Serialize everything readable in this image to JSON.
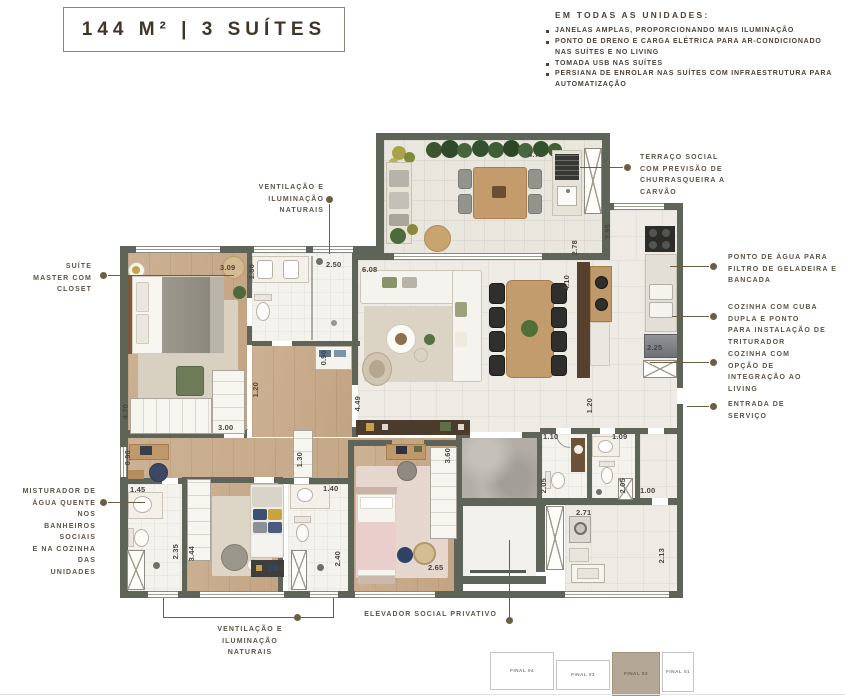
{
  "title": "144 M² | 3 SUÍTES",
  "features": {
    "heading": "EM TODAS AS UNIDADES:",
    "items": [
      "JANELAS AMPLAS, PROPORCIONANDO MAIS ILUMINAÇÃO",
      "PONTO DE DRENO E CARGA ELÉTRICA PARA AR-CONDICIONADO NAS SUÍTES E NO LIVING",
      "TOMADA USB NAS SUÍTES",
      "PERSIANA DE ENROLAR NAS SUÍTES COM INFRAESTRUTURA PARA AUTOMATIZAÇÃO"
    ]
  },
  "callouts": {
    "suite_master": "SUÍTE\nMASTER COM\nCLOSET",
    "ventilacao_top": "VENTILAÇÃO E\nILUMINAÇÃO\nNATURAIS",
    "terraco": "TERRAÇO SOCIAL\nCOM PREVISÃO DE\nCHURRASQUEIRA A\nCARVÃO",
    "ponto_agua": "PONTO DE ÁGUA PARA\nFILTRO DE GELADEIRA E\nBANCADA",
    "cozinha_cuba": "COZINHA COM CUBA\nDUPLA E PONTO\nPARA INSTALAÇÃO DE\nTRITURADOR",
    "cozinha_living": "COZINHA COM\nOPÇÃO DE\nINTEGRAÇÃO AO\nLIVING",
    "entrada_servico": "ENTRADA DE\nSERVIÇO",
    "misturador": "MISTURADOR DE\nÁGUA QUENTE NOS\nBANHEIROS SOCIAIS\nE NA COZINHA DAS\nUNIDADES",
    "ventilacao_bottom": "VENTILAÇÃO E\nILUMINAÇÃO\nNATURAIS",
    "elevador": "ELEVADOR SOCIAL PRIVATIVO"
  },
  "dims": [
    "4.70",
    "3.95",
    "2.78",
    "4.10",
    "2.25",
    "6.08",
    "4.49",
    "1.20",
    "1.10",
    "1.09",
    "2.05",
    "2.05",
    "1.00",
    "2.71",
    "2.13",
    "3.09",
    "1.80",
    "2.50",
    "0.90",
    "1.20",
    "4.70",
    "3.00",
    "0.90",
    "1.45",
    "2.35",
    "3.44",
    "2.55",
    "1.30",
    "1.40",
    "2.40",
    "2.65",
    "3.60"
  ],
  "keyplan": {
    "units": [
      "FINAL 04",
      "FINAL 03",
      "FINAL 02",
      "FINAL 01"
    ],
    "highlighted": "FINAL 02"
  },
  "colors": {
    "wall": "#5f6458",
    "callout_text": "#5d5447",
    "leader": "#6b5e43",
    "title": "#3f352a",
    "keyplan_highlight": "#b5a795"
  }
}
